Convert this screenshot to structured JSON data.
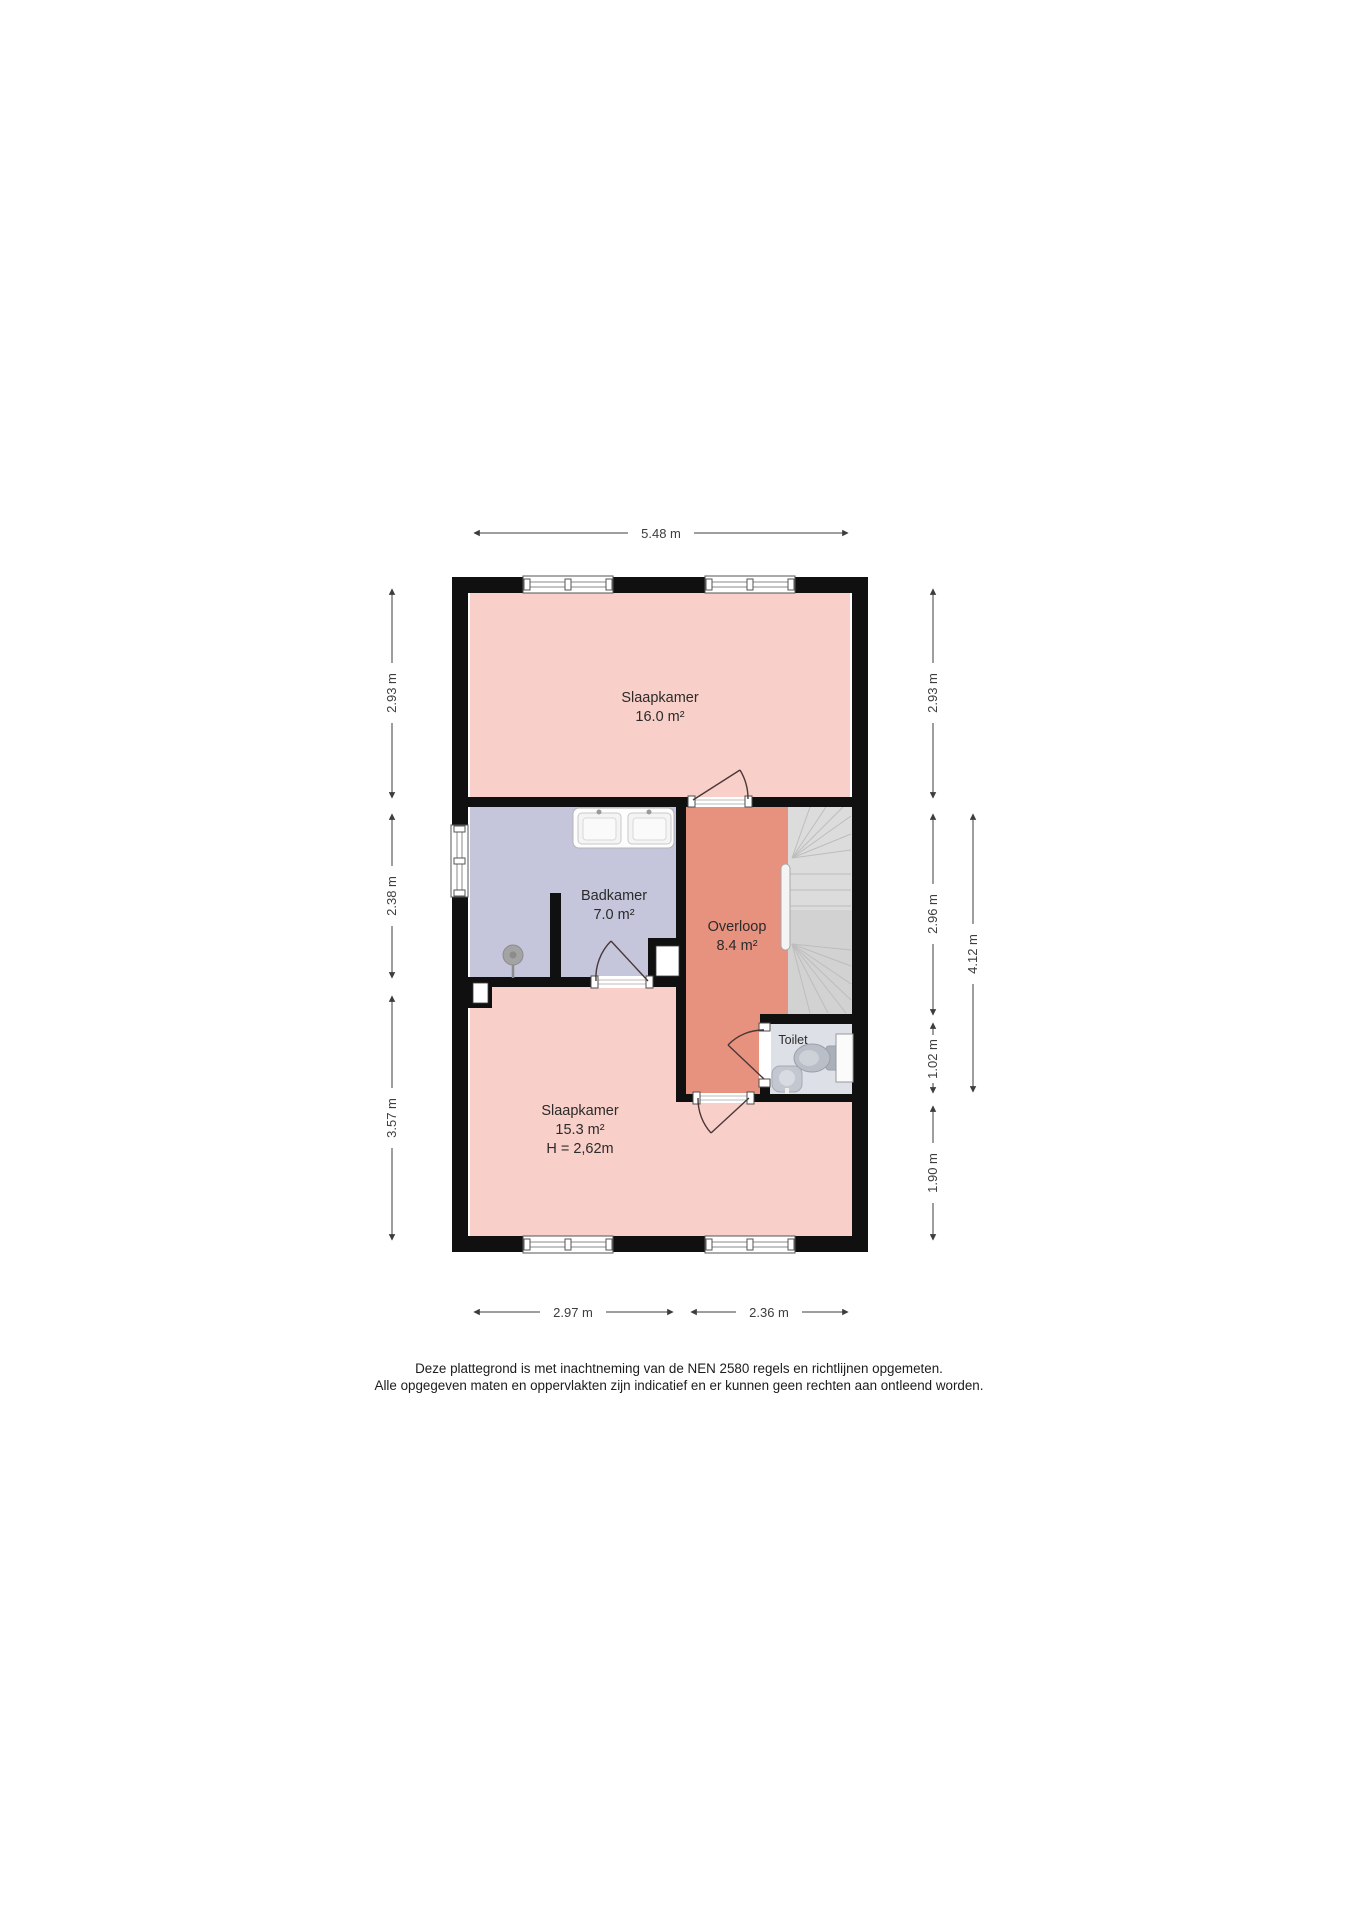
{
  "rooms": {
    "slaapkamer1": {
      "label": "Slaapkamer",
      "area": "16.0 m²",
      "color": "#f9d0c9"
    },
    "badkamer": {
      "label": "Badkamer",
      "area": "7.0 m²",
      "color": "#c5c5dc"
    },
    "overloop": {
      "label": "Overloop",
      "area": "8.4 m²",
      "color": "#e7917f"
    },
    "toilet": {
      "label": "Toilet",
      "color": "#dde0e6"
    },
    "slaapkamer2": {
      "label": "Slaapkamer",
      "area": "15.3 m²",
      "height_note": "H = 2,62m",
      "color": "#f9d0c9"
    }
  },
  "dimensions": {
    "top_width": "5.48 m",
    "left_top": "2.93 m",
    "left_middle": "2.38 m",
    "left_bottom": "3.57 m",
    "right_top": "2.93 m",
    "right_upper_middle": "2.96 m",
    "right_lower_middle": "1.02 m",
    "right_bottom": "1.90 m",
    "right_outer": "4.12 m",
    "bottom_left": "2.97 m",
    "bottom_right": "2.36 m"
  },
  "footer": {
    "line1": "Deze plattegrond is met inachtneming van de NEN 2580 regels en richtlijnen opgemeten.",
    "line2": "Alle opgegeven maten en oppervlakten zijn indicatief en er kunnen geen rechten aan ontleend worden."
  },
  "colors": {
    "wall": "#101010",
    "dimension": "#3d3d3d",
    "door_swing": "#4a3737",
    "stairs_upper": "#dcdcdc",
    "stairs_lower": "#d2d2d2"
  }
}
